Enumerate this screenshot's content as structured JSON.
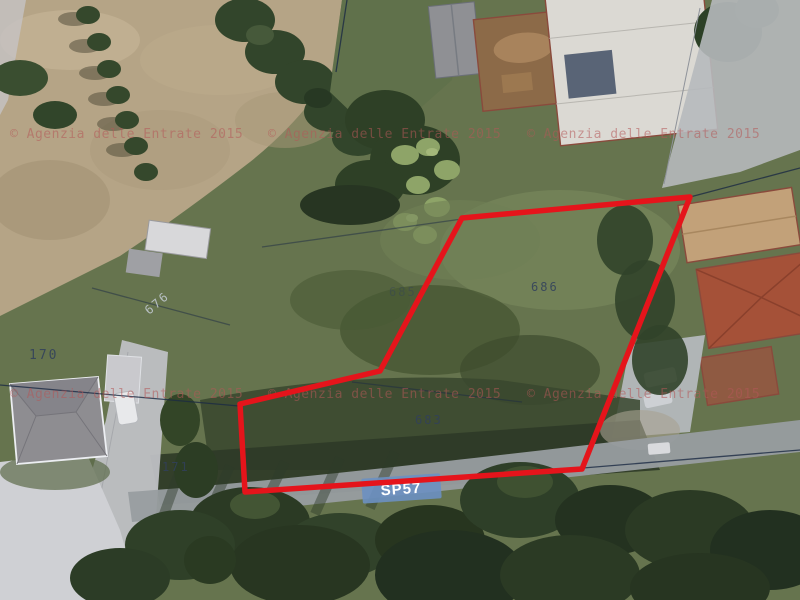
{
  "map": {
    "description": "Aerial cadastral map with selected parcel outlined in red",
    "watermark_text": "© Agenzia delle Entrate 2015",
    "road_label": "SP57",
    "parcels": [
      {
        "label": "686"
      },
      {
        "label": "683"
      },
      {
        "label": "685"
      },
      {
        "label": "170"
      },
      {
        "label": "171"
      },
      {
        "label": "676"
      }
    ],
    "selection": {
      "points": "462,218 690,197 582,469 245,492 240,404 380,371"
    },
    "colors": {
      "selection": "#e5141b",
      "boundary-line": "#1c2a44",
      "road-badge-bg": "#6c90c2",
      "road-badge-text": "#ffffff",
      "watermark": "#b45858",
      "parcel-label": "#31405c"
    }
  }
}
